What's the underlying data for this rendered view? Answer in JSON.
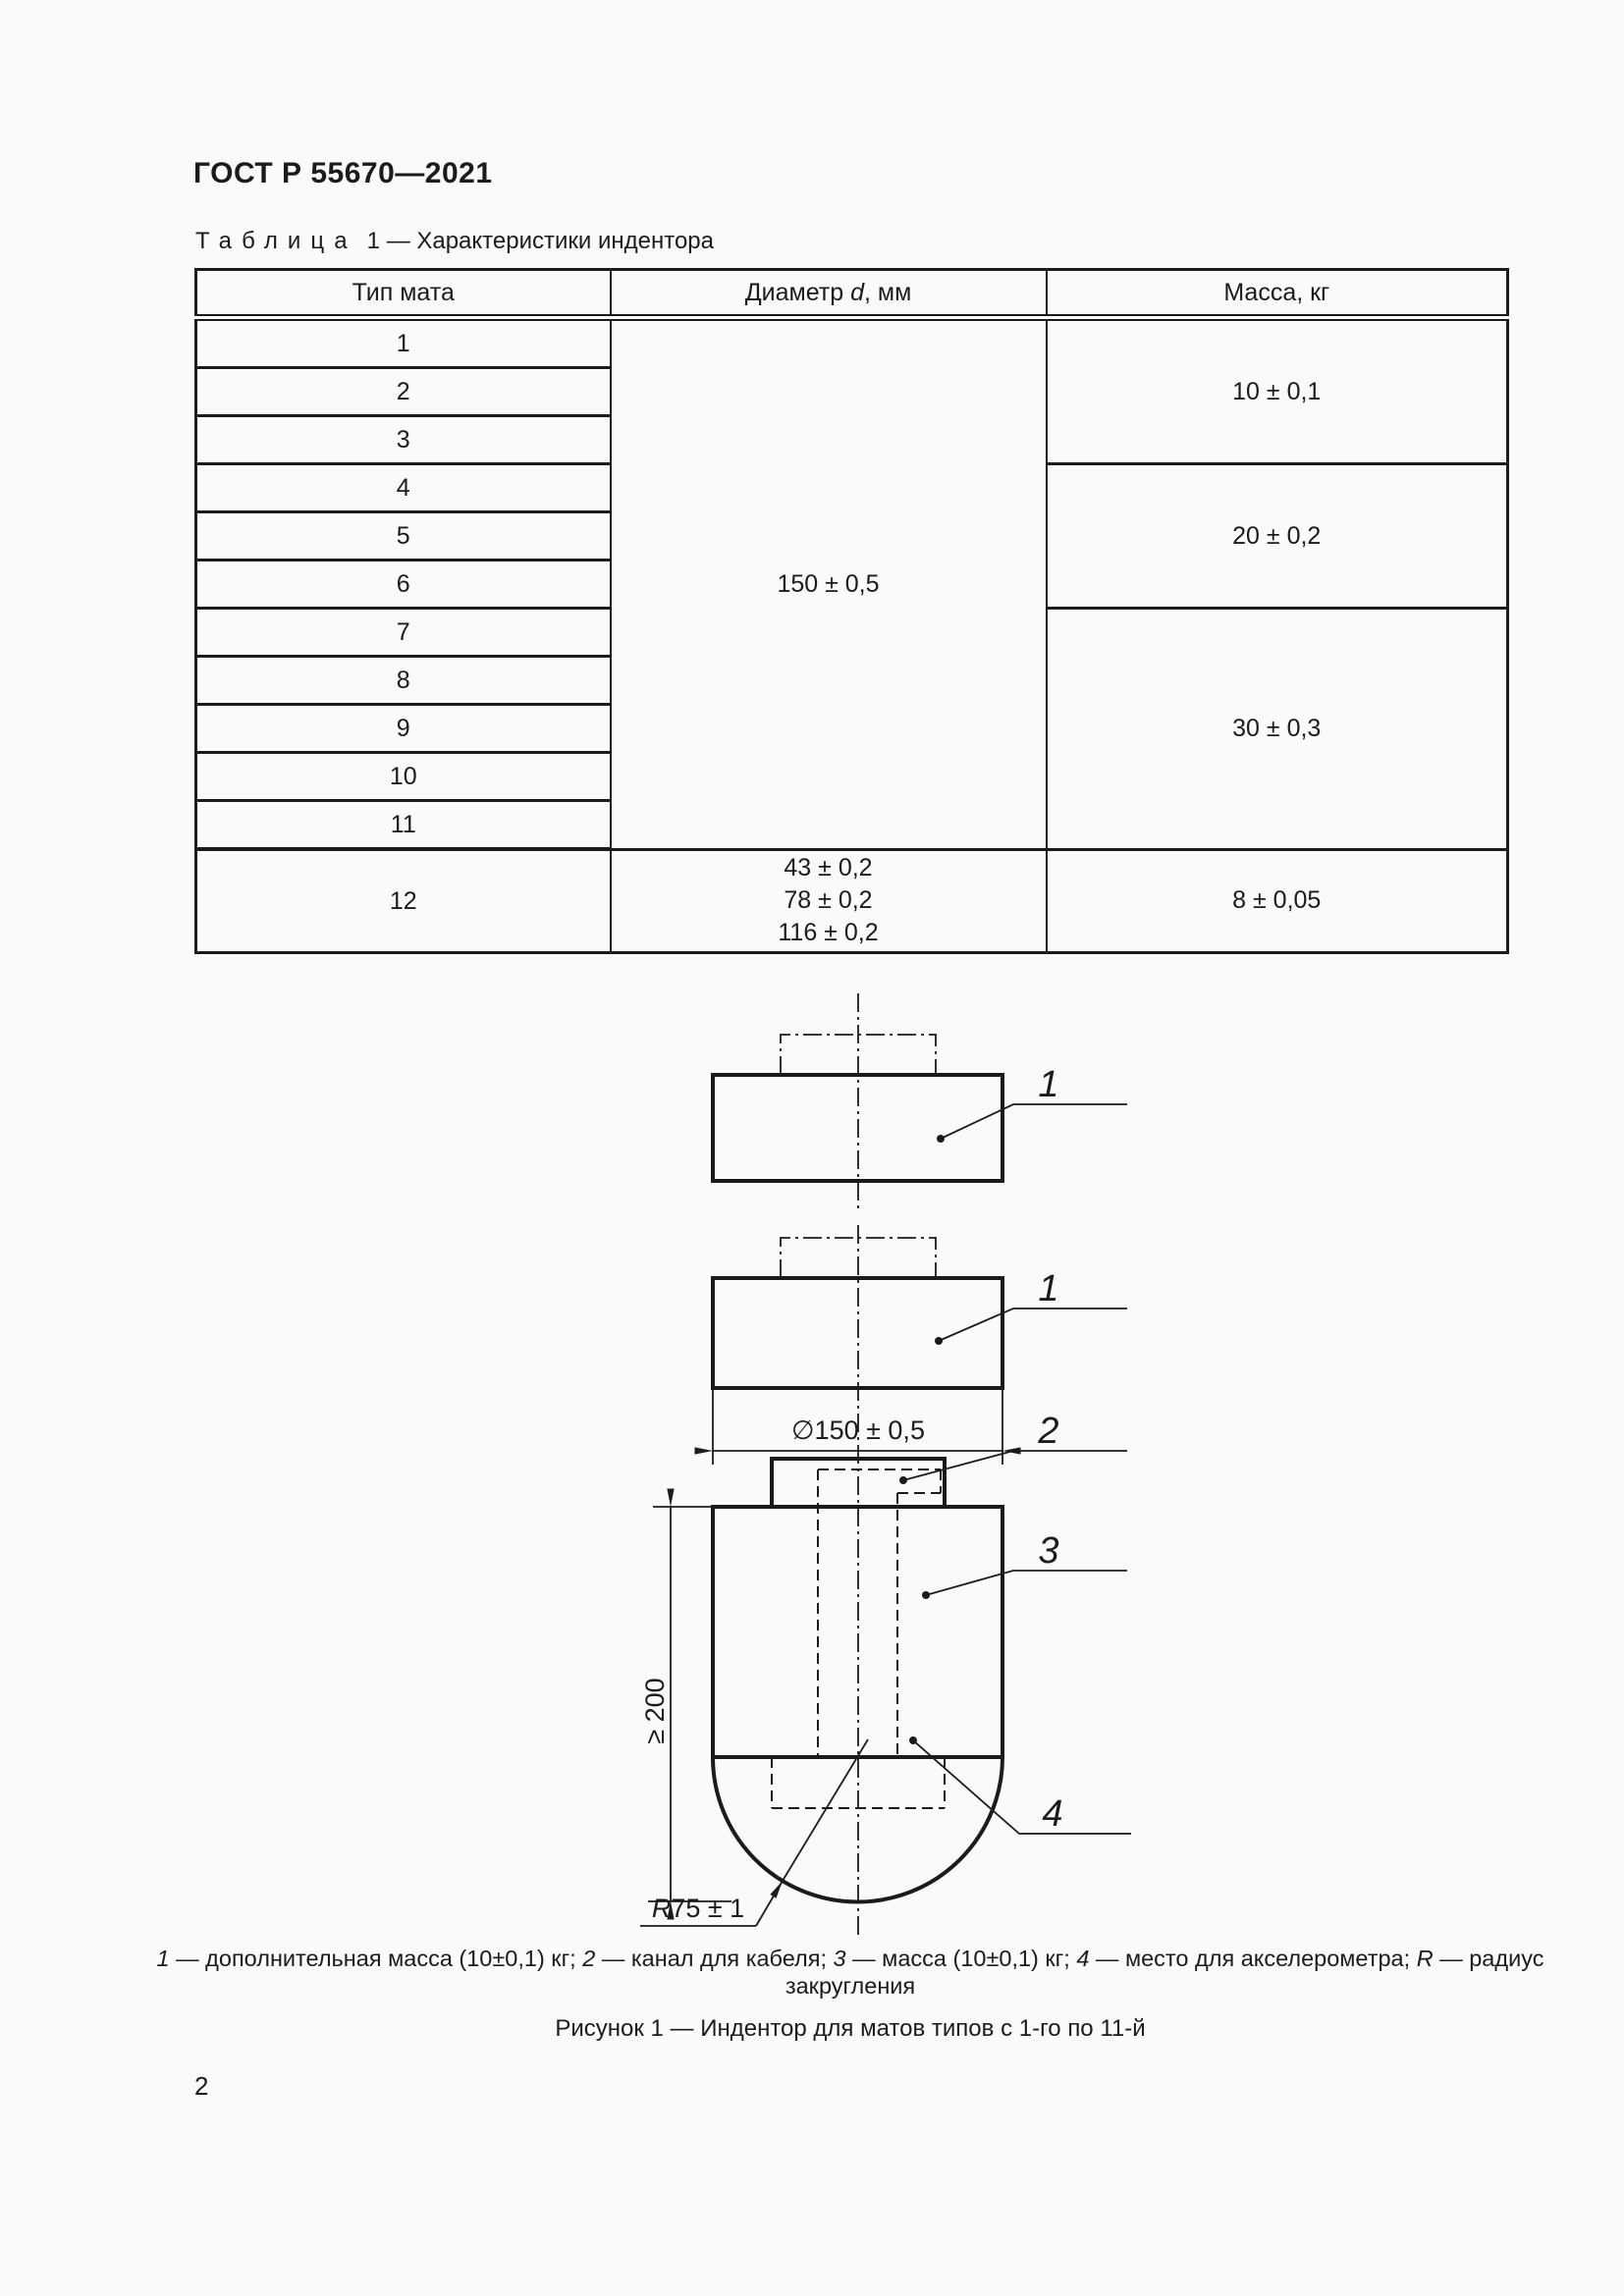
{
  "page": {
    "header": "ГОСТ Р 55670—2021",
    "number": "2"
  },
  "table": {
    "title_word": "Таблица",
    "title_rest": "1 — Характеристики индентора",
    "columns": {
      "type": "Тип мата",
      "diameter_pre": "Диаметр ",
      "diameter_var": "d",
      "diameter_post": ", мм",
      "mass": "Масса, кг"
    },
    "types": [
      "1",
      "2",
      "3",
      "4",
      "5",
      "6",
      "7",
      "8",
      "9",
      "10",
      "11",
      "12"
    ],
    "diameter_main": "150 ± 0,5",
    "diameter_12": [
      "43 ± 0,2",
      "78 ± 0,2",
      "116 ± 0,2"
    ],
    "mass_groups": [
      "10 ± 0,1",
      "20 ± 0,2",
      "30 ± 0,3",
      "8 ± 0,05"
    ]
  },
  "figure": {
    "labels": {
      "l1a": "1",
      "l1b": "1",
      "l2": "2",
      "l3": "3",
      "l4": "4"
    },
    "dims": {
      "diameter": "∅150 ± 0,5",
      "height": "≥ 200",
      "radius_var": "R",
      "radius_val": "75 ± 1"
    },
    "caption_parts": [
      "1",
      " — дополнительная масса (10±0,1) кг; ",
      "2",
      " — канал для кабеля; ",
      "3",
      " — масса (10±0,1) кг; ",
      "4",
      " — место для акселерометра; ",
      "R",
      " — радиус"
    ],
    "caption_line2": "закругления",
    "figcaption": "Рисунок 1 — Индентор для матов типов с 1-го по 11-й"
  },
  "colors": {
    "ink": "#1b1b1b",
    "paper": "#fafafa"
  }
}
